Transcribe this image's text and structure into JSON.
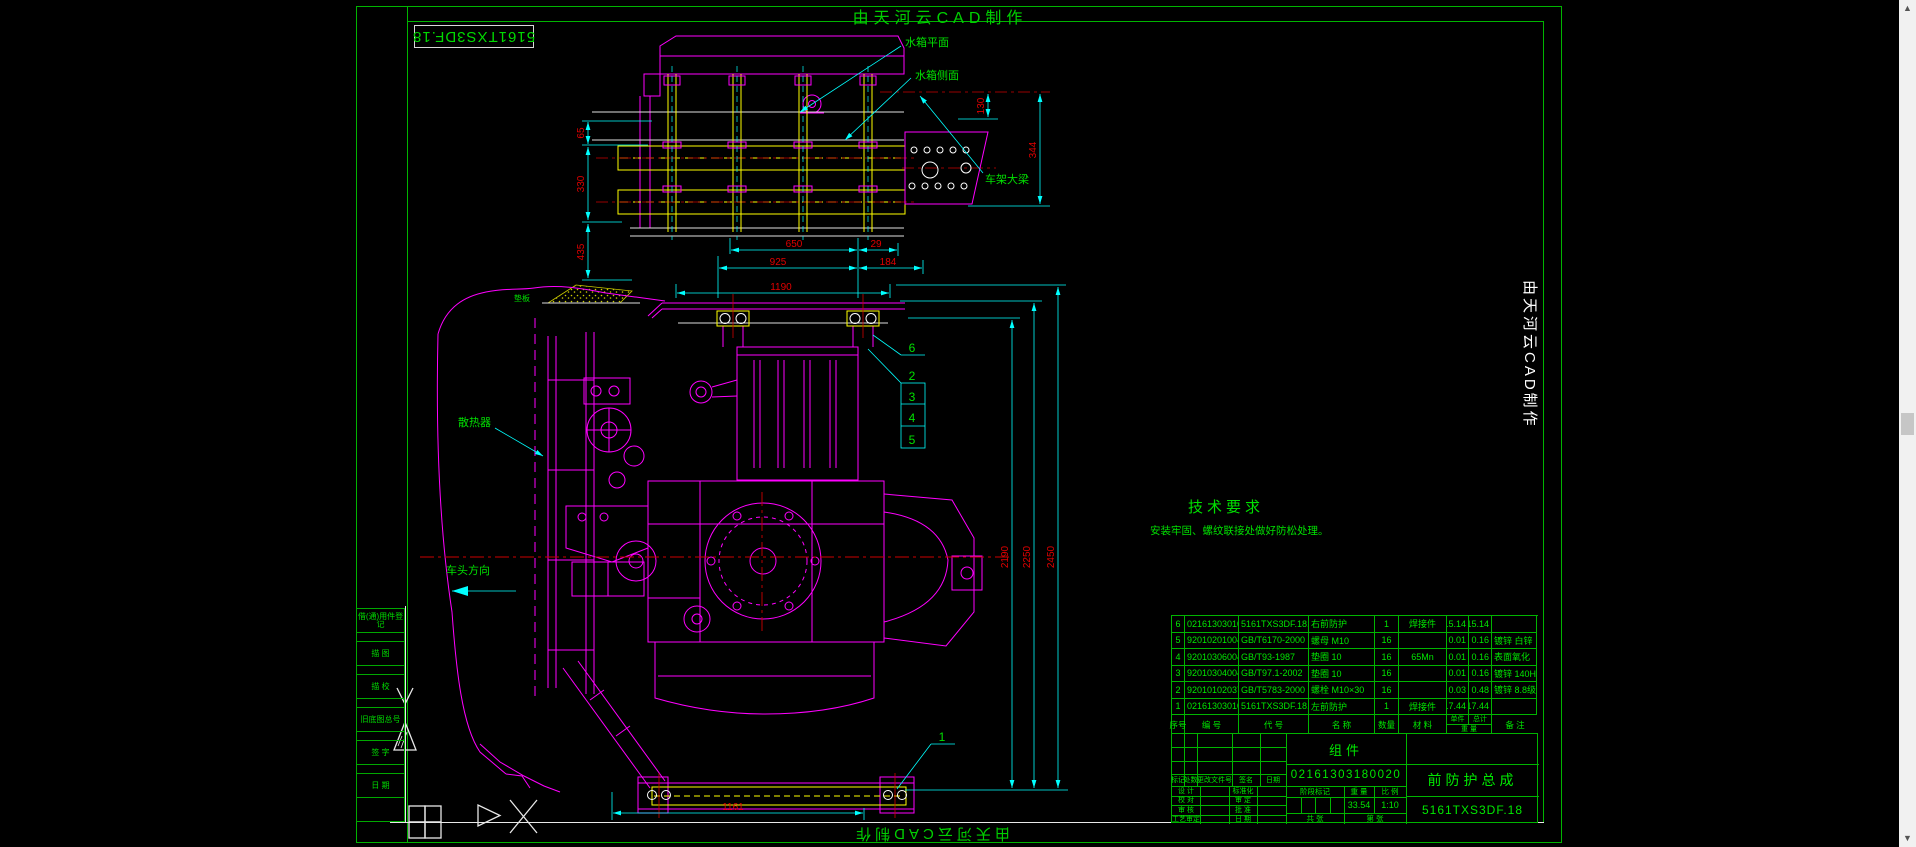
{
  "page": {
    "maker_top": "由天河云CAD制作",
    "maker_bottom": "由天河云CAD制作",
    "maker_right": "由天河云CAD制作",
    "corner_code": "5161TXS3DF.18"
  },
  "strip": {
    "items": [
      "借(通)用件登记",
      "描 图",
      "描 校",
      "旧底图总号",
      "签 字",
      "日 期"
    ]
  },
  "notes": {
    "title": "技术要求",
    "body": "安装牢固、螺纹联接处做好防松处理。"
  },
  "labels": {
    "radiator_plane": "水箱平面",
    "radiator_side": "水箱侧面",
    "frame_rail": "车架大梁",
    "radiator": "散热器",
    "direction": "车头方向",
    "pad": "垫板"
  },
  "dims": {
    "d65": "65",
    "d330": "330",
    "d435": "435",
    "d130": "130",
    "d344": "344",
    "d650": "650",
    "d29": "29",
    "d925": "925",
    "d184": "184",
    "d1190": "1190",
    "d2190": "2190",
    "d2250": "2250",
    "d2450": "2450",
    "d1161": "1161"
  },
  "balloons": {
    "b1": "1",
    "b2": "2",
    "b3": "3",
    "b4": "4",
    "b5": "5",
    "b6": "6"
  },
  "bom": {
    "headers": {
      "seq": "序号",
      "num": "编  号",
      "code": "代  号",
      "name": "名  称",
      "qty": "数量",
      "mat": "材  料",
      "unit": "单件",
      "total": "总计",
      "weight": "重  量",
      "remark": "备 注"
    },
    "rows": [
      {
        "cells": [
          "6",
          "02161303010120",
          "5161TXS3DF.18.2",
          "右前防护",
          "1",
          "焊接件",
          "15.14",
          "15.14",
          ""
        ]
      },
      {
        "cells": [
          "5",
          "9201020100401",
          "GB/T6170-2000",
          "螺母 M10",
          "16",
          "",
          "0.01",
          "0.16",
          "镀锌 白锌"
        ]
      },
      {
        "cells": [
          "4",
          "9201030600401",
          "GB/T93-1987",
          "垫圈 10",
          "16",
          "65Mn",
          "0.01",
          "0.16",
          "表面氧化"
        ]
      },
      {
        "cells": [
          "3",
          "9201030400401",
          "GB/T97.1-2002",
          "垫圈 10",
          "16",
          "",
          "0.01",
          "0.16",
          "镀锌 140HV"
        ]
      },
      {
        "cells": [
          "2",
          "9201010203701",
          "GB/T5783-2000",
          "螺栓 M10×30",
          "16",
          "",
          "0.03",
          "0.48",
          "镀锌 8.8级"
        ]
      },
      {
        "cells": [
          "1",
          "02161303010110",
          "5161TXS3DF.18.1",
          "左前防护",
          "1",
          "焊接件",
          "17.44",
          "17.44",
          ""
        ]
      }
    ]
  },
  "title_block": {
    "type_label": "组件",
    "drawing_no": "02161303180020",
    "product_name": "前防护总成",
    "product_code": "5161TXS3DF.18",
    "stage_label": "阶段标记",
    "weight_label": "重 量",
    "scale_label": "比 例",
    "weight": "33.54",
    "scale": "1:10",
    "sheets_total": "共 张",
    "sheet_no": "第 张",
    "mark_row": {
      "mark": "标记",
      "count": "处数",
      "doc": "更改文件号",
      "sign": "签名",
      "date": "日期"
    },
    "roles_left": [
      "设 计",
      "校 对",
      "审 核",
      "工艺审定"
    ],
    "roles_right": [
      "标准化",
      "审 定",
      "批 准",
      "日 期"
    ]
  }
}
